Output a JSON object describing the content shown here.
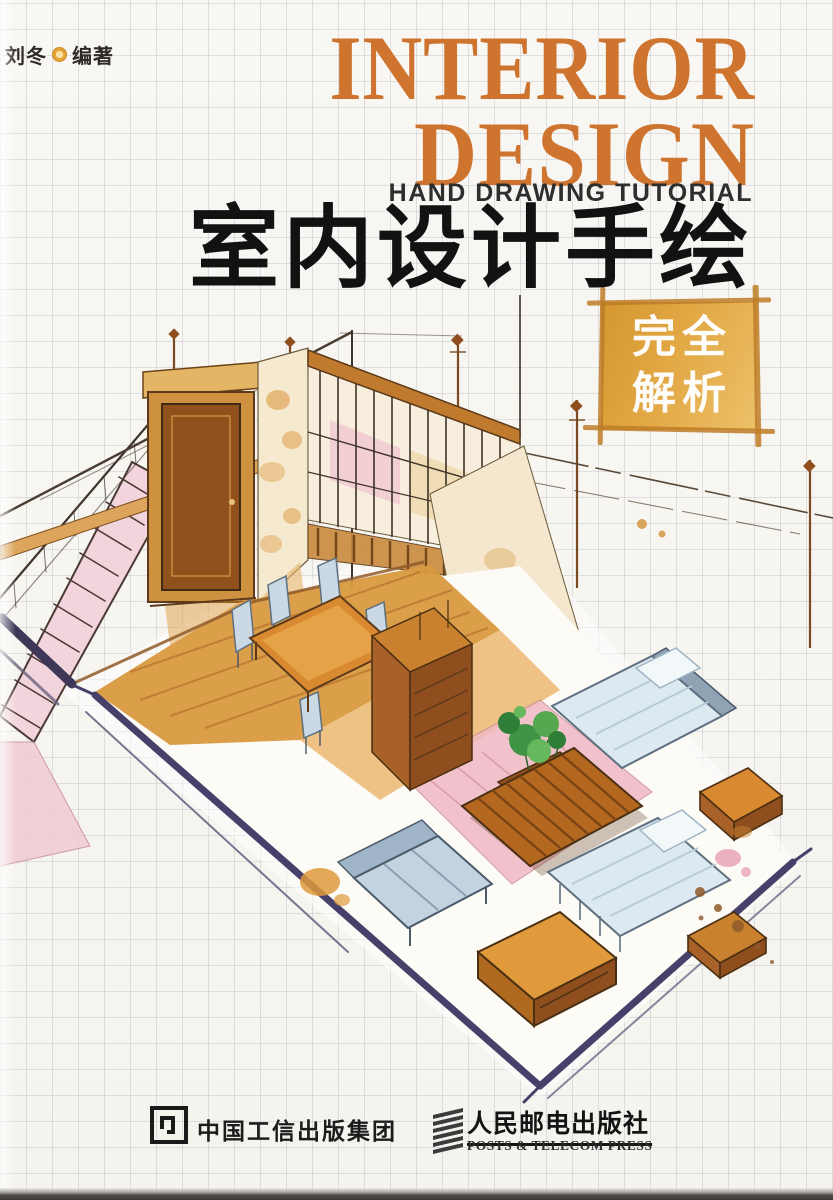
{
  "cover": {
    "author": {
      "name": "刘冬",
      "role": "编著"
    },
    "title_en_line1": "INTERIOR",
    "title_en_line2": "DESIGN",
    "subtitle_en": "HAND DRAWING TUTORIAL",
    "title_zh": "室内设计手绘",
    "badge": {
      "line1": "完全",
      "line2": "解析"
    },
    "publisher_group": {
      "name": "中国工信出版集团"
    },
    "press": {
      "name_zh": "人民邮电出版社",
      "name_en": "POSTS & TELECOM PRESS"
    },
    "colors": {
      "title_orange": "#CE742F",
      "badge_gold": "#E0A23E",
      "title_black": "#121212",
      "paper": "#F8F6F2",
      "baseboard_purple": "#46406A",
      "wood_orange": "#D9993F",
      "furniture_blue": "#C9D8E4",
      "rug_pink": "#EFB9C4",
      "plant_green": "#3F9445"
    },
    "illustration_alt": "Hand-drawn marker sketch: axonometric cutaway of a furnished interior with staircase, wooden door, railing wall, dining set, plant, pink rug and beds"
  }
}
